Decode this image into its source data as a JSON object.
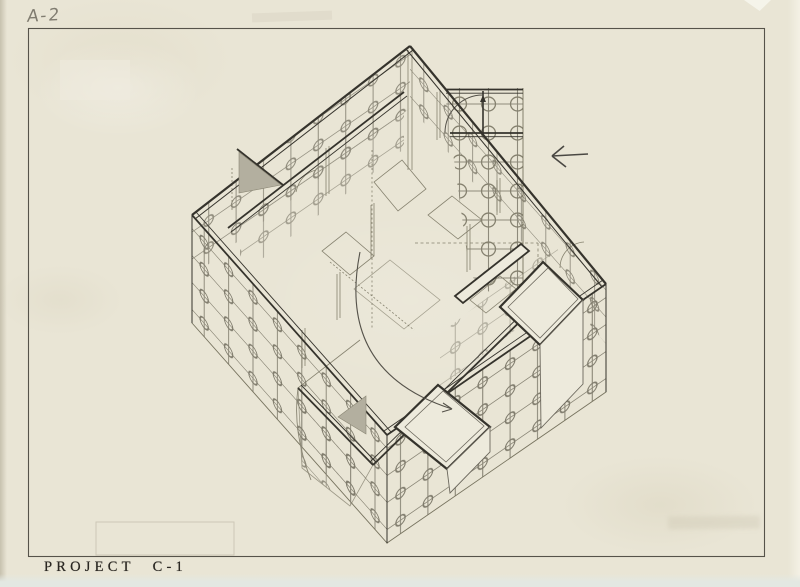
{
  "sheet": {
    "number": "A-2"
  },
  "caption": {
    "project": "PROJECT",
    "code": "C-1"
  },
  "symbols": {
    "direction_arrow": "left-arrow",
    "drawing_type": "axonometric-plan"
  },
  "colors": {
    "paper": "#e9e5d5",
    "ink": "#35332c",
    "ink_light": "#8e8a7b",
    "pencil": "#807c70",
    "shade_gray": "#b3af9f",
    "panel_white": "#edeadc",
    "frame": "#56534a"
  }
}
